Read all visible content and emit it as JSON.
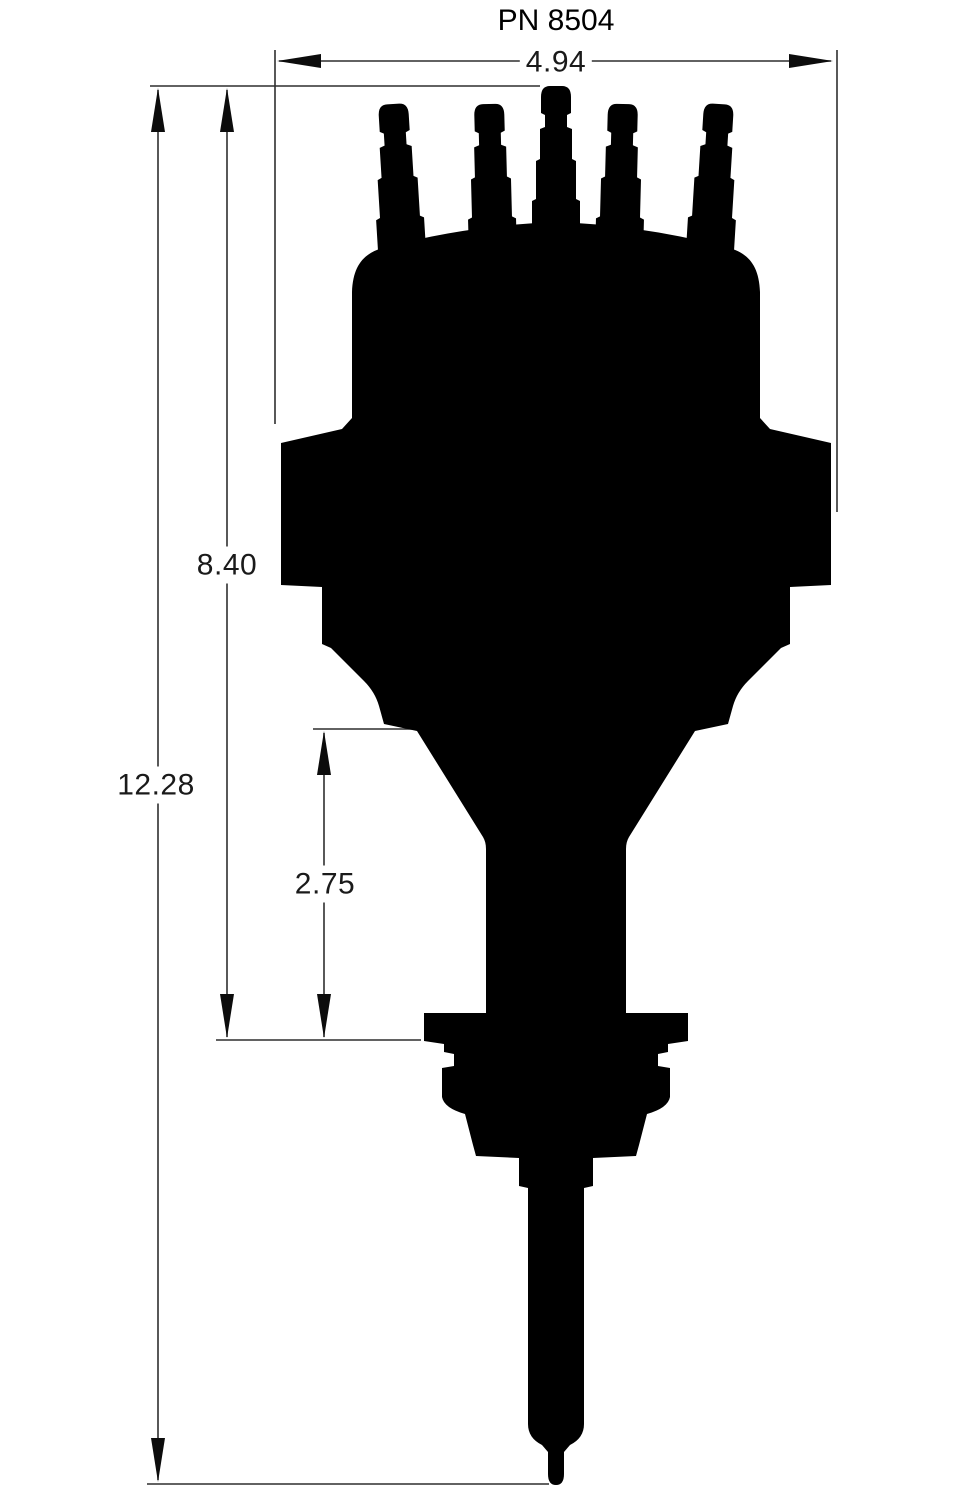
{
  "title": "PN 8504",
  "diagram": {
    "description": "distributor-side-profile-silhouette",
    "dimensions": {
      "cap_width": {
        "value": "4.94",
        "orientation": "horizontal",
        "measures": "widest cap diameter"
      },
      "body_height": {
        "value": "8.40",
        "orientation": "vertical",
        "measures": "cap top to mounting flange bottom"
      },
      "overall_height": {
        "value": "12.28",
        "orientation": "vertical",
        "measures": "cap top to shaft tip"
      },
      "lower_height": {
        "value": "2.75",
        "orientation": "vertical",
        "measures": "body taper start to mounting flange bottom"
      }
    },
    "colors": {
      "silhouette_fill": "#000000",
      "line": "#2f2f2f",
      "background": "#ffffff",
      "text": "#1a1a1a"
    }
  }
}
